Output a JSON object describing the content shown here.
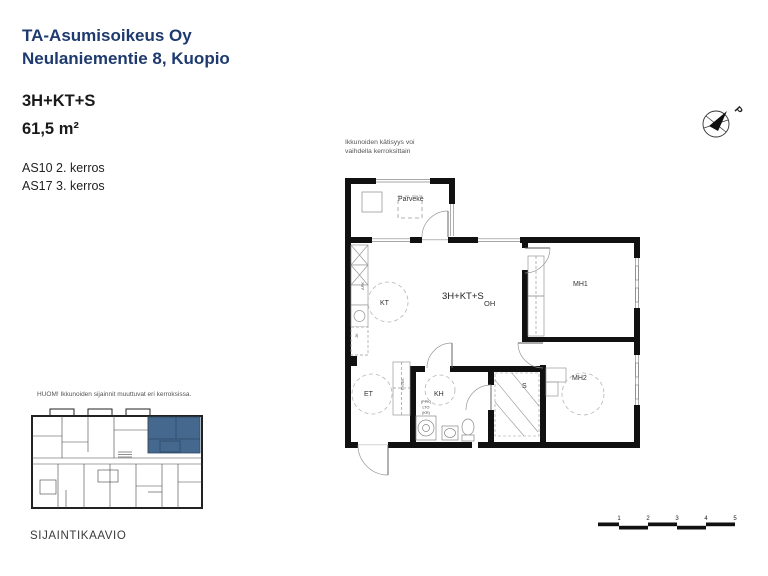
{
  "header": {
    "company": "TA-Asumisoikeus Oy",
    "address": "Neulaniementie 8, Kuopio",
    "apartment_type": "3H+KT+S",
    "area": "61,5 m²",
    "units": [
      "AS10 2. kerros",
      "AS17 3. kerros"
    ]
  },
  "window_note": {
    "line1": "Ikkunoiden kätisyys voi",
    "line2": "vaihdella kerroksittain"
  },
  "floor_plan": {
    "type_label": "3H+KT+S",
    "rooms": {
      "balcony": "Parveke",
      "kitchen": "KT",
      "living_room": "OH",
      "bedroom1": "MH1",
      "bedroom2": "MH2",
      "hall": "ET",
      "bathroom": "KH",
      "sauna": "S",
      "utility_closet": "PY/EK"
    },
    "appliances": {
      "dishwasher": "APK",
      "fridge": "JK",
      "stack": [
        "(PPK)",
        "LTO",
        "(KR)"
      ]
    }
  },
  "site_plan": {
    "note": "HUOM! Ikkunoiden sijainnit muuttuvat eri kerroksissa.",
    "title": "SIJAINTIKAAVIO"
  },
  "north_arrow": {
    "label": "P"
  },
  "scale_bar": {
    "ticks": [
      "1",
      "2",
      "3",
      "4",
      "5"
    ]
  },
  "colors": {
    "brand_blue": "#1e3a6e",
    "highlight_blue": "#44688e"
  }
}
